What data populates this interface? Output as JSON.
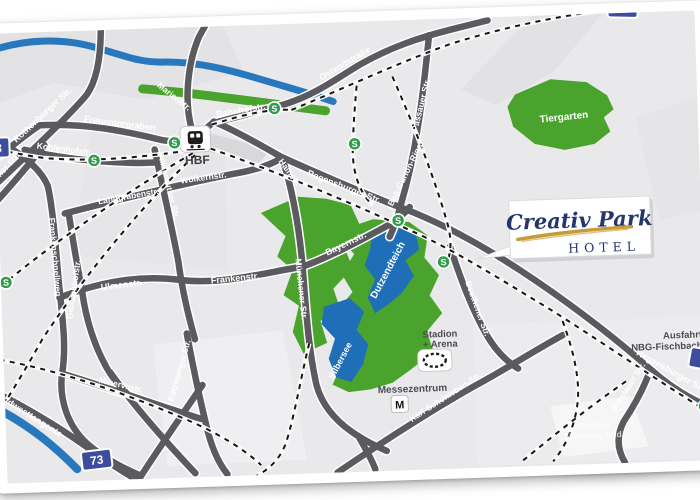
{
  "map": {
    "logo": {
      "name": "Creativ Park",
      "subtitle": "HOTEL"
    },
    "badges": {
      "a3": "3",
      "a73": "73"
    },
    "transit": {
      "sbahn": "S"
    },
    "areas": {
      "tiergarten": "Tiergarten"
    },
    "lakes": {
      "dutzendteich": "Dutzendteich",
      "silbersee": "Silbersee"
    },
    "streets": {
      "rothenburger": "Rothenburger Str.",
      "frauentorgraben": "Frauentorgraben",
      "kohlenhofstr": "Kohlenhofstr.",
      "schwabacher": "Schwabacher Str.",
      "marienstr": "Marienstr.",
      "bahnhofstr": "Bahnhofstr.",
      "ostendstrasse": "Ostendstraße",
      "hainstr": "Hainstr.",
      "pillenreuther": "Pillenreuther Str.",
      "landgrabenstr": "Landgrabenstr.",
      "woelkernstr": "Wölkernstr.",
      "frankenschnellweg": "Frankenschnellweg",
      "gibitzenhofstr": "Gibitzenhofstr.",
      "ulmenstr": "Ulmenstr.",
      "frankenstr": "Frankenstr.",
      "muenchener": "Münchener Str.",
      "bayernstr": "Bayernstr.",
      "regensburger": "Regensburger Str.",
      "passauer": "Passauer Str.",
      "bengurion": "Ben-Gurion-Ring",
      "beuthener": "Beuthener Str.",
      "katzwanger": "Katzwanger Str.",
      "minervastr": "Minervastr.",
      "suedwesttangente": "Südwesttangente",
      "karlschoenleben": "Karl-Schönleben-Str.",
      "breslauer": "Breslauer Str."
    },
    "pois": {
      "hbf": "HBF",
      "messezentrum": "Messezentrum",
      "metro": "M",
      "stadion_line1": "Stadion",
      "stadion_line2": "+ Arena",
      "ausfahrt_line1": "Ausfahrt",
      "ausfahrt_line2": "NBG-Fischbach",
      "klinikum_line1": "Klinikum",
      "klinikum_line2": "Nürnberg Süd"
    },
    "colors": {
      "road": "#5a5a5f",
      "water": "#2878be",
      "park": "#4aa32c",
      "lake": "#1f6fb8",
      "autobahn_badge": "#3c4da0",
      "sbahn_green": "#2f9e4b",
      "logo_navy": "#25356e",
      "logo_gold": "#c79a3a"
    }
  }
}
